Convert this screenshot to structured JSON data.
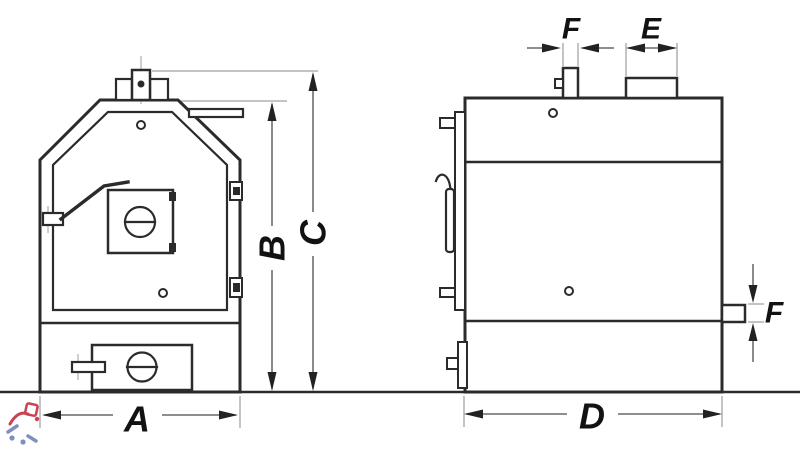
{
  "drawing": {
    "kind": "boiler two-view dimensional diagram",
    "labels": {
      "a": "A",
      "b": "B",
      "c": "C",
      "d": "D",
      "e": "E",
      "f_top": "F",
      "f_side": "F"
    }
  },
  "colors": {
    "background": "#ffffff",
    "line": "#2b2b2b",
    "dimension": "#4b4b4b",
    "label": "#121212",
    "watermark_red": "#c22f3e",
    "watermark_blue": "#7285b5"
  }
}
